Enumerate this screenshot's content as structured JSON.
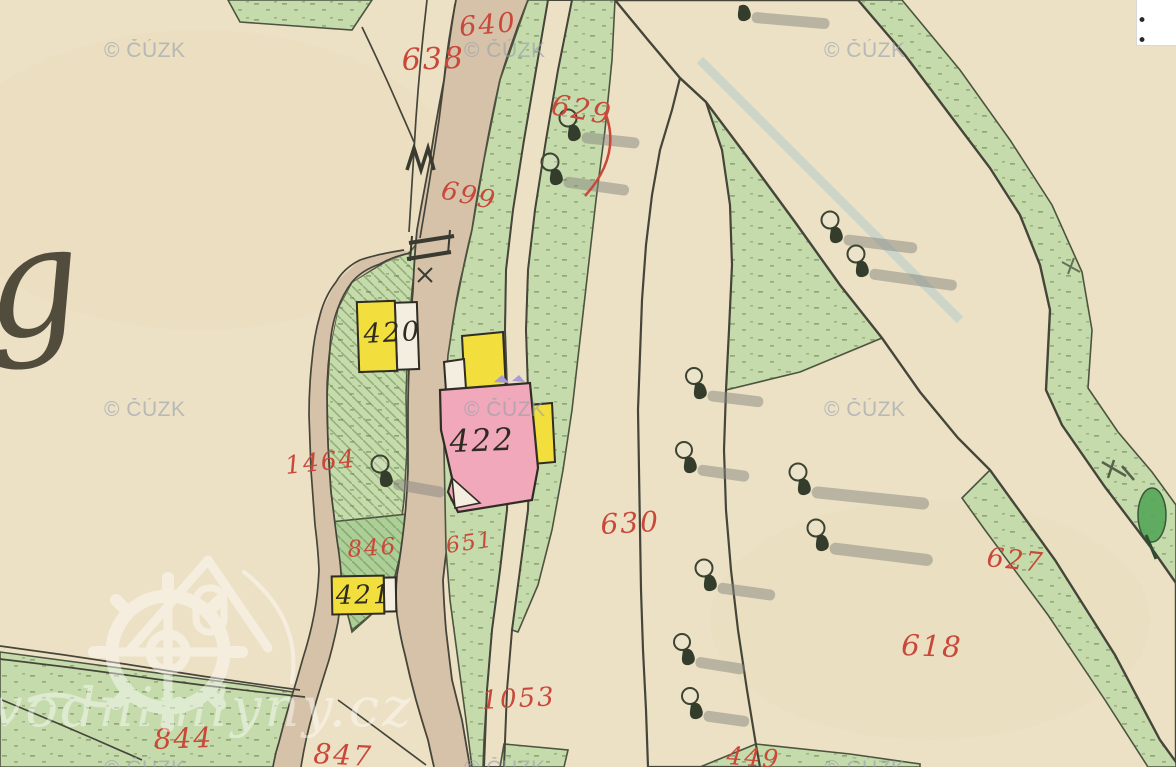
{
  "ui": {
    "more_options_dots": "• •"
  },
  "watermarks": {
    "cuzk": "© ČÚZK",
    "site": "vodnimlyny.cz"
  },
  "map": {
    "script_letter": "g",
    "parcel_labels": {
      "n640": "640",
      "n638": "638",
      "n629": "629",
      "n699": "699",
      "n1464": "1464",
      "n846": "846",
      "n651": "651",
      "n630": "630",
      "n627": "627",
      "n618": "618",
      "n1053": "1053",
      "n844": "844",
      "n847": "847",
      "n449": "449"
    },
    "building_labels": {
      "b420": "420",
      "b422": "422",
      "b421": "421"
    },
    "colors": {
      "paper": "#EDE1C5",
      "water": "#A7D2DD",
      "meadow": "#C6DBAB",
      "meadow_dark": "#ABCF97",
      "road": "#D6C1A9",
      "building_yellow": "#F2DE3C",
      "building_pink": "#F1A8BA",
      "label_red": "#C8483A",
      "ink": "#45453A"
    }
  }
}
